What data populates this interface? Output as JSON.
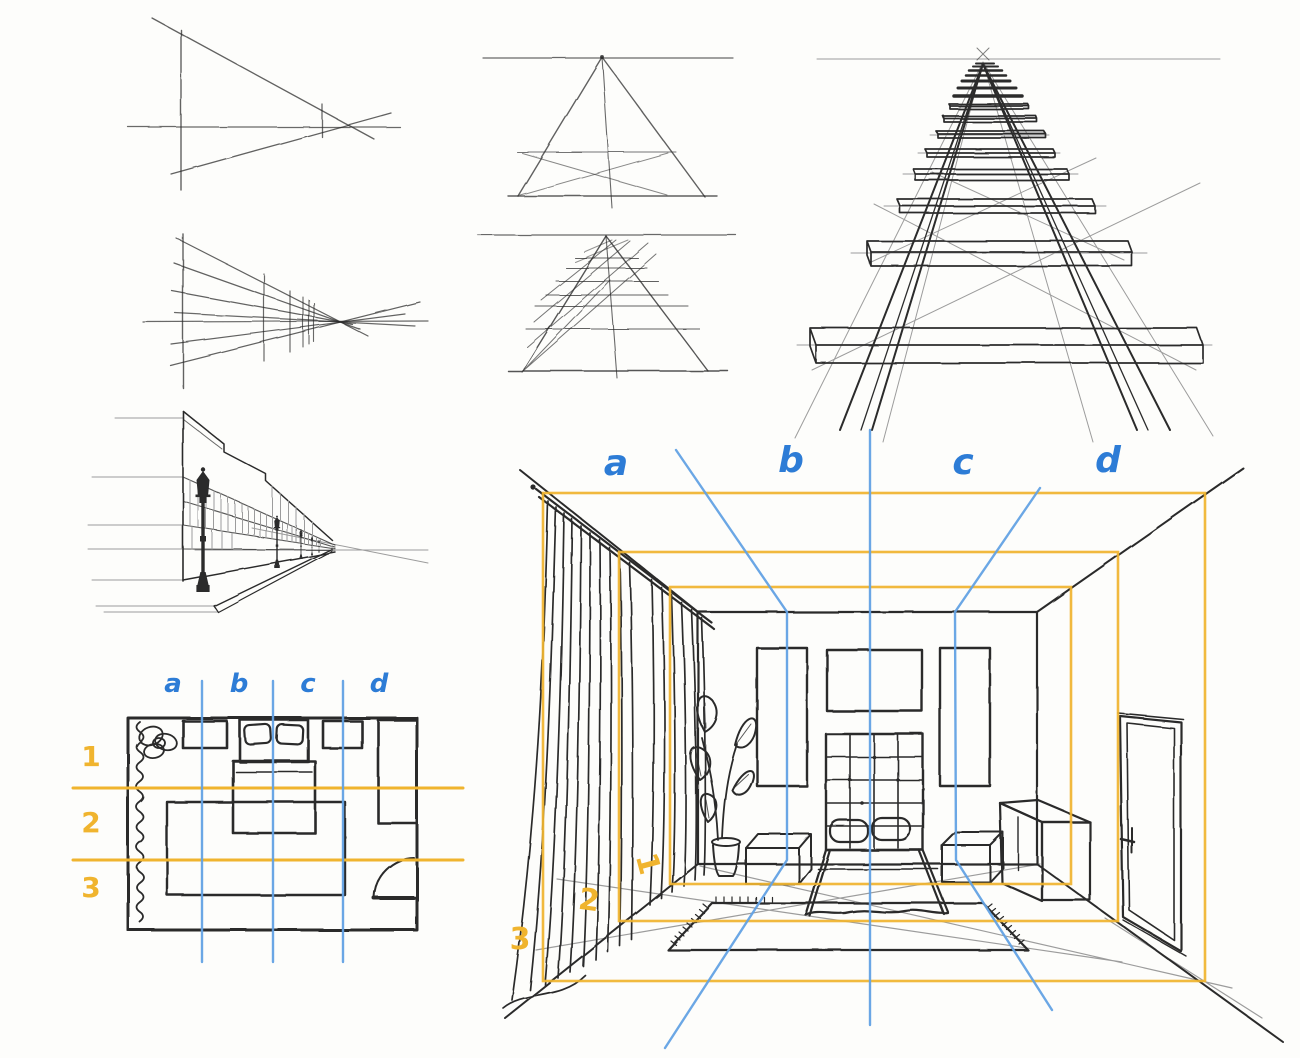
{
  "palette": {
    "ink": "#2b2b2b",
    "construction": "#9c9c9c",
    "blue_line": "#63a2e4",
    "blue_label": "#2d7cd6",
    "orange": "#f0b42e",
    "paper": "#fdfdfb"
  },
  "floor_plan": {
    "column_labels": [
      "a",
      "b",
      "c",
      "d"
    ],
    "row_labels": [
      "1",
      "2",
      "3"
    ]
  },
  "room_view": {
    "column_labels": [
      "a",
      "b",
      "c",
      "d"
    ],
    "row_labels": [
      "1",
      "2",
      "3"
    ]
  }
}
